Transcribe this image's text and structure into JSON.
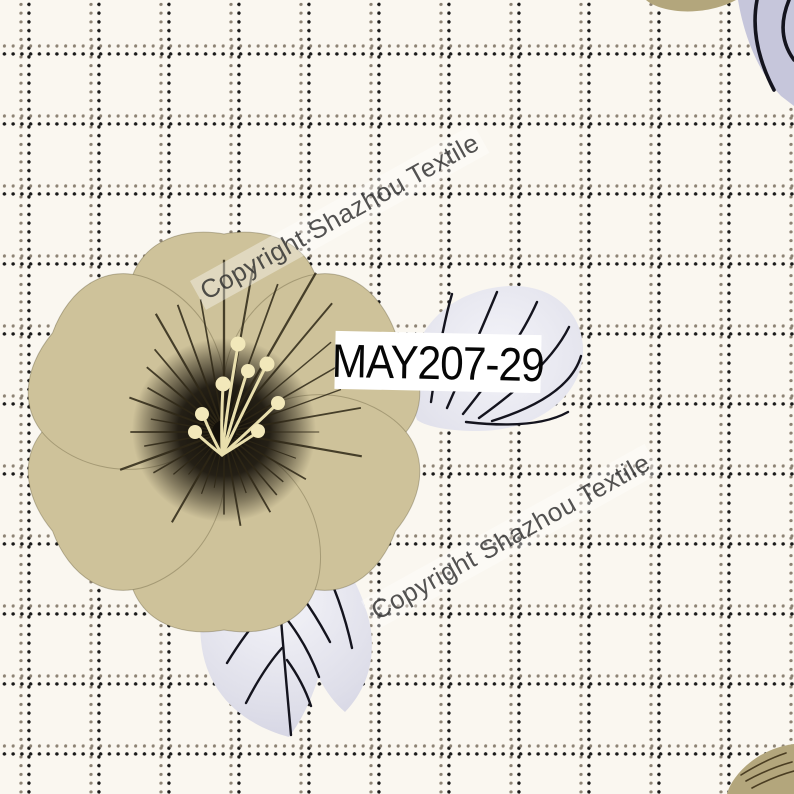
{
  "artwork": {
    "kind": "textile-print-pattern-swatch",
    "code_label": "MAY207-29",
    "watermark_text": "Copyright Shazhou Textile",
    "watermark_instances": 2,
    "watermark_angle_deg": -29
  },
  "pattern": {
    "background": "dotted windowpane grid on cream ground",
    "grid_cell_px": 70,
    "grid_dot_pitch_px": 8.75,
    "motifs": [
      "large khaki mallow flower with dark radiating center and cream stamens",
      "fan-veined lavender leaf right of flower (under code label)",
      "pinnate lavender leaf below flower",
      "lavender leaf clipped at top-right edge",
      "khaki petal fragment at top edge",
      "khaki petal fragment at bottom-right corner"
    ]
  },
  "colors": {
    "background": "#faf7f0",
    "grid_gray_dot": "#8d8374",
    "grid_black_dot": "#1a1a1a",
    "petal_khaki": "#b3a67c",
    "petal_light_edge": "#cec29a",
    "flower_center_dark": "#15110a",
    "streak_brown": "#2e2716",
    "stamen_cream": "#f2e8ba",
    "leaf_lavender": "#d6d6e5",
    "leaf_vein_black": "#14141e",
    "watermark_gray": "#3c3c3c",
    "label_background": "#ffffff",
    "label_text": "#060606"
  }
}
